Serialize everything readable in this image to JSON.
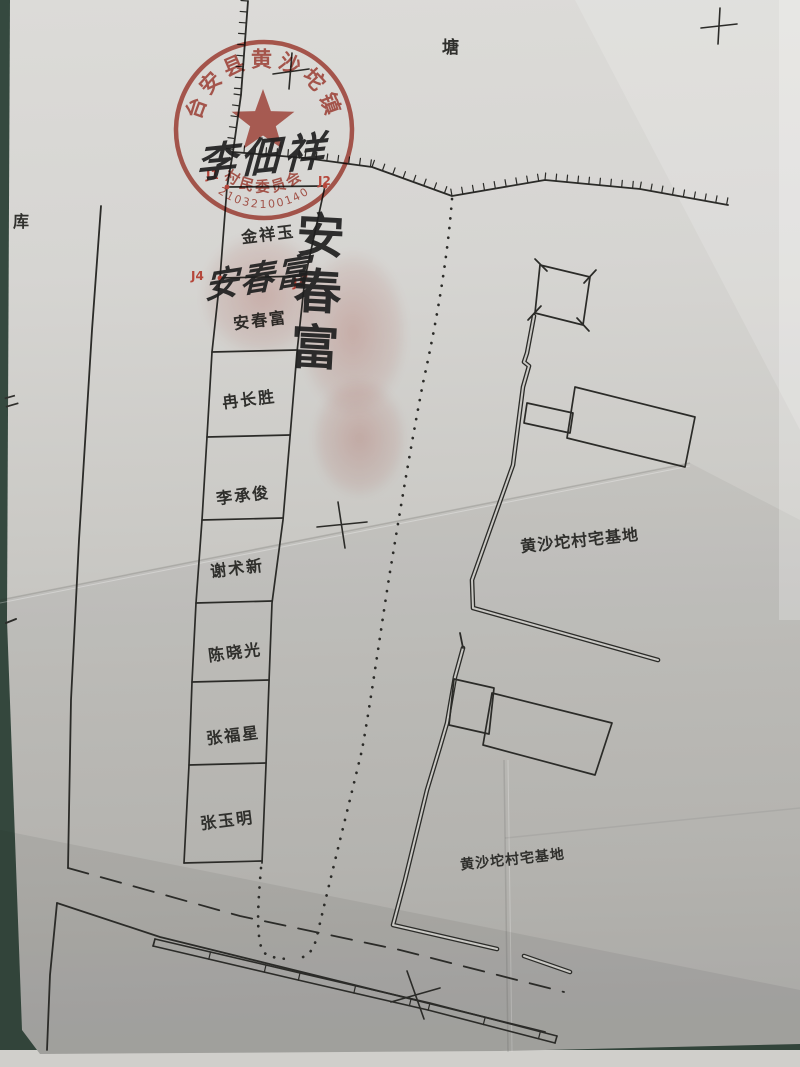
{
  "labels": {
    "pond": "塘",
    "reservoir": "库",
    "margin_mark": "二",
    "homestead_upper": "黄沙坨村宅基地",
    "homestead_lower": "黄沙坨村宅基地"
  },
  "seal": {
    "ring_text": "台安县黄沙坨镇",
    "bottom_text": "村民委员会",
    "code_number": "21032100140",
    "color": "#b5473b"
  },
  "survey_markers": {
    "j1": "J1",
    "j2": "J2",
    "j3": "J3",
    "j4": "J4"
  },
  "parcels": [
    {
      "owner": "金祥玉"
    },
    {
      "owner": "安春富"
    },
    {
      "owner": "冉长胜"
    },
    {
      "owner": "李承俊"
    },
    {
      "owner": "谢术新"
    },
    {
      "owner": "陈晓光"
    },
    {
      "owner": "张福星"
    },
    {
      "owner": "张玉明"
    }
  ],
  "handwriting": {
    "stamp_signature": "李佃祥",
    "parcel_signature": "安春富",
    "vertical_signature": "安春富"
  }
}
